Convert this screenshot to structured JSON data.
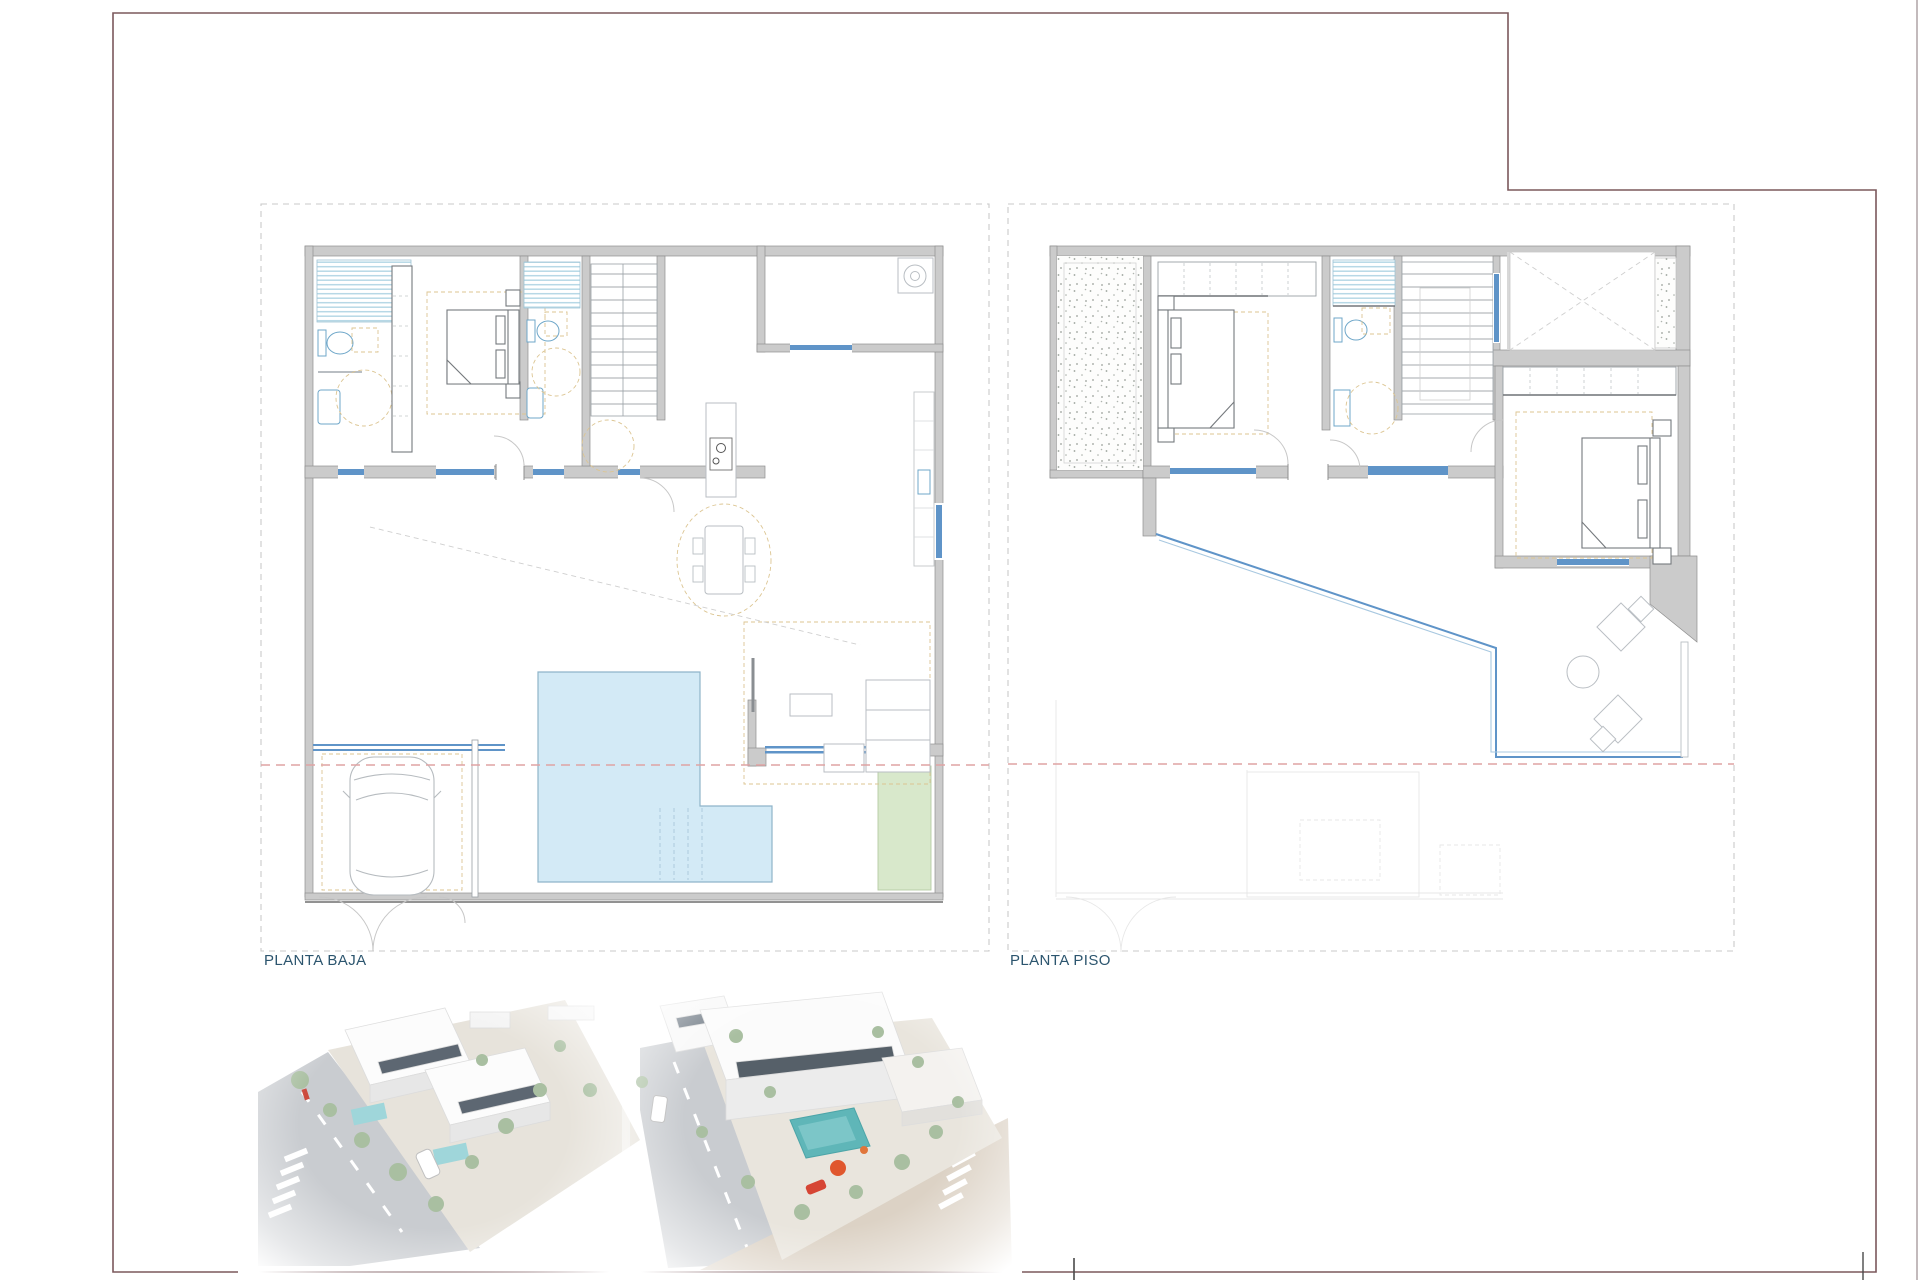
{
  "page": {
    "description": "architectural drawing sheet with two floor plans and two aerial renders",
    "background": "#ffffff",
    "sheet_border_color": "#7b585c",
    "right_edge_line_color": "#9b8d8f"
  },
  "plans": {
    "ground_floor": {
      "label": "PLANTA BAJA"
    },
    "upper_floor": {
      "label": "PLANTA PISO"
    },
    "label_color": "#2c556e"
  },
  "palette": {
    "wall_fill": "#cbcbcb",
    "wall_stroke": "#8f8f8f",
    "window_blue": "#5f94c8",
    "railing_blue_light": "#a8c8e0",
    "shower_stripe_blue": "#b7d8e6",
    "pool_fill": "#d3eaf6",
    "pool_stroke": "#8fb4c9",
    "garden_green_fill": "#d8e8cb",
    "garden_green_stroke": "#b5cba3",
    "furniture_light_gray": "#b9bec3",
    "furniture_dark_gray": "#73777b",
    "accent_dash_yellow": "#dcc592",
    "setback_dash_red": "#dfa3a3",
    "boundary_dash_gray": "#c9c9c9",
    "stipple_gray": "#9aa09a",
    "render_pool_teal": "#5fb6b8",
    "render_accent_orange": "#e0572e",
    "render_road_gray": "#c9ccd0",
    "render_ground_beige": "#dcd2c5",
    "render_tree_green": "#a9bfa1"
  },
  "renders": {
    "left": {
      "name": "aerial-render-development-overview"
    },
    "right": {
      "name": "aerial-render-corner-closeup"
    }
  }
}
